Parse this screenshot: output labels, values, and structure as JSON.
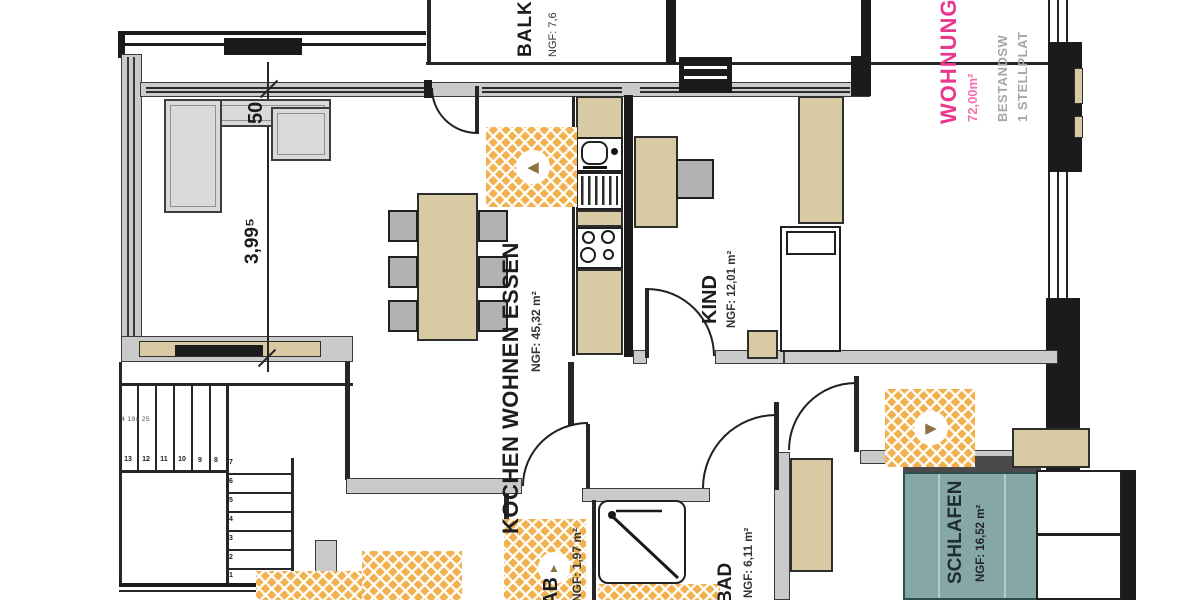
{
  "annotation": {
    "title": "WOHNUNG",
    "area": "72,00m²",
    "line1": "BESTANDSW",
    "line2": "1 STELLPLAT"
  },
  "rooms": {
    "balkon": {
      "name": "BALK",
      "area": "NGF: 7,6"
    },
    "wohnen": {
      "name": "KOCHEN WOHNEN ESSEN",
      "area": "NGF: 45,32 m²"
    },
    "kind": {
      "name": "KIND",
      "area": "NGF: 12,01 m²"
    },
    "schlafen": {
      "name": "SCHLAFEN",
      "area": "NGF: 16,52 m²"
    },
    "bad": {
      "name": "BAD",
      "area": "NGF: 6,11 m²"
    },
    "abstell": {
      "name": "AB",
      "area": "NGF: 1,97 m²"
    }
  },
  "dimensions": {
    "width_50": "50",
    "height_399": "3,99⁵",
    "stair_note": "4 19x 25"
  },
  "stairs": {
    "run1": [
      "13",
      "12",
      "11",
      "10",
      "9",
      "8"
    ],
    "turn": "7",
    "run2": [
      "6",
      "5",
      "4",
      "3",
      "2",
      "1"
    ]
  },
  "markers": {
    "arrow_left": "◀",
    "arrow_right": "▶",
    "arrow_up": "▲"
  },
  "colors": {
    "pink": "#e8388c",
    "pink_light": "#f172ab",
    "gray_text": "#a6a6a6",
    "tan": "#d8caa3",
    "lattice": "#f0b14e",
    "teal": "#85a8a7",
    "wall_gray": "#cacaca",
    "ink": "#1c1c1c"
  }
}
